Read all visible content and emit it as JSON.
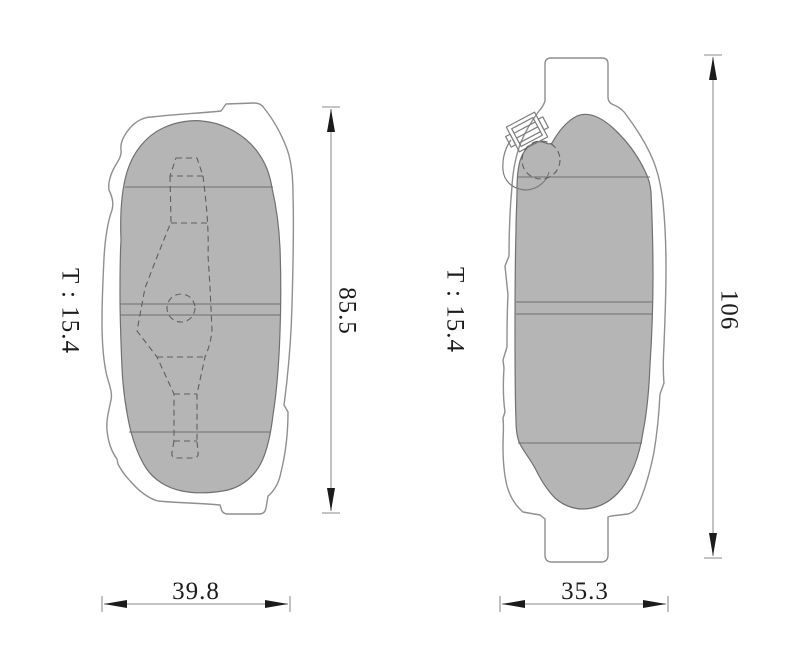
{
  "diagram": {
    "type": "technical-drawing",
    "subject": "brake-pads-two-views",
    "views": {
      "left": {
        "thickness_label": "T : 15.4",
        "height_label": "85.5",
        "width_label": "39.8"
      },
      "right": {
        "thickness_label": "T : 15.4",
        "height_label": "106",
        "width_label": "35.3"
      }
    },
    "colors": {
      "background": "#ffffff",
      "pad_fill": "#b5b5b5",
      "pad_stroke": "#707070",
      "plate_stroke": "#8f8f8f",
      "dimension_line": "#a0a0a0",
      "arrow_fill": "#1b1b1b",
      "text_color": "#1b1b1b"
    }
  }
}
